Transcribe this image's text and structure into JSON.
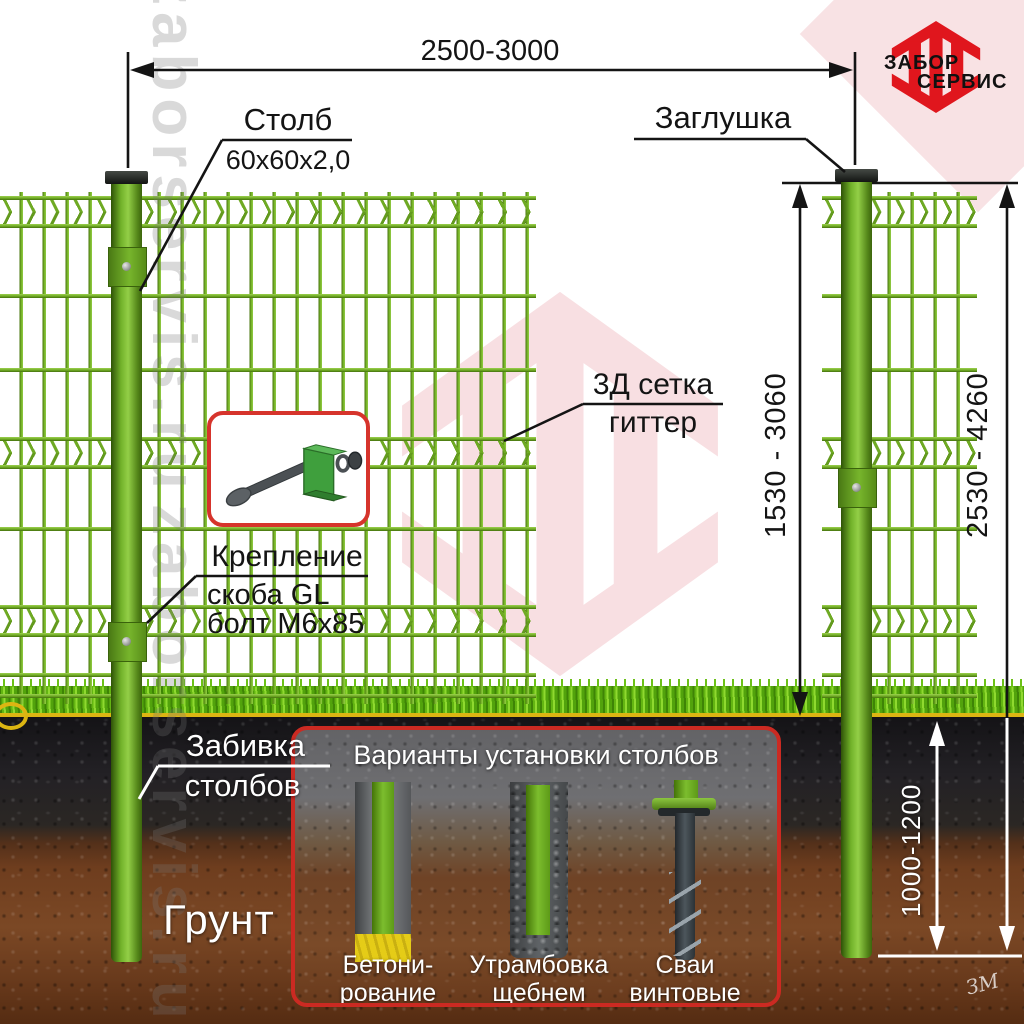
{
  "brand": {
    "name_line1": "ЗАБОР",
    "name_line2": "СЕРВИС",
    "watermark": "zaborservis.ru"
  },
  "dimensions": {
    "span": "2500-3000",
    "mesh_height": "1530 - 3060",
    "post_total": "2530 - 4260",
    "depth": "1000-1200"
  },
  "callouts": {
    "post": {
      "title": "Столб",
      "size": "60х60х2,0"
    },
    "cap": {
      "title": "Заглушка"
    },
    "mesh": {
      "line1": "3Д сетка",
      "line2": "гиттер"
    },
    "fastener": {
      "title": "Крепление",
      "line1": "скоба GL",
      "line2": "болт М6х85"
    },
    "driving": {
      "line1": "Забивка",
      "line2": "столбов"
    },
    "soil": {
      "title": "Грунт"
    }
  },
  "options_panel": {
    "title": "Варианты установки столбов",
    "options": [
      {
        "line1": "Бетони-",
        "line2": "рование"
      },
      {
        "line1": "Утрамбовка",
        "line2": "щебнем"
      },
      {
        "line1": "Сваи",
        "line2": "винтовые"
      }
    ]
  },
  "signature": "ЗМ",
  "colors": {
    "brand_red": "#e0161d",
    "mesh_green": "#76b42a",
    "panel_border_red": "#cb2a22",
    "concrete_yellow": "#e5cc17",
    "dimension_text": "#141414"
  }
}
